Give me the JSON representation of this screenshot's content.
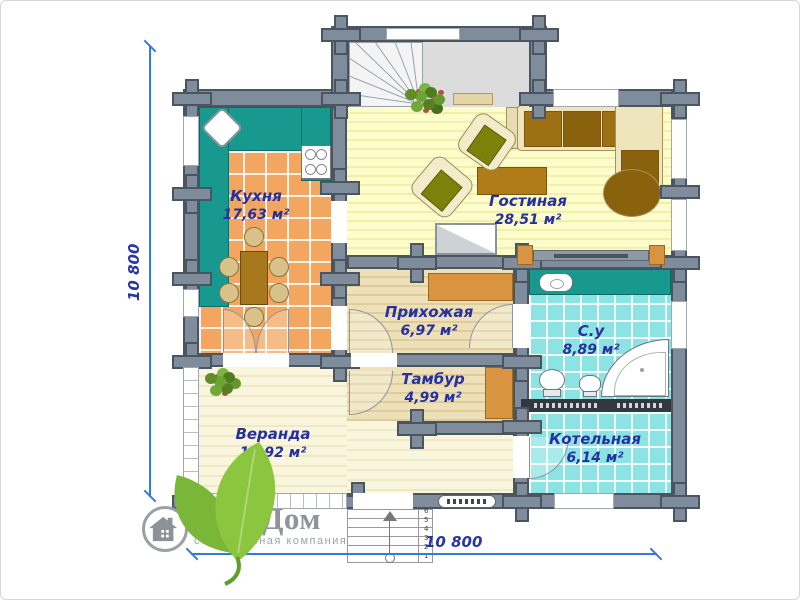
{
  "plan": {
    "rooms": [
      {
        "name": "Кухня",
        "area": "17,63 м²"
      },
      {
        "name": "Гостиная",
        "area": "28,51 м²"
      },
      {
        "name": "Прихожая",
        "area": "6,97 м²"
      },
      {
        "name": "Тамбур",
        "area": "4,99 м²"
      },
      {
        "name": "С.у",
        "area": "8,89 м²"
      },
      {
        "name": "Котельная",
        "area": "6,14 м²"
      },
      {
        "name": "Веранда",
        "area": "15,92 м²"
      }
    ],
    "dimensions": {
      "left": "10 800",
      "bottom": "10 800"
    },
    "entry_steps": {
      "numbers": [
        "1",
        "2",
        "3",
        "4",
        "5",
        "6"
      ]
    },
    "colors": {
      "wall": "#7e8c9c",
      "wall_outline": "#4a5560",
      "counter_teal": "#17998f",
      "kitchen_tile": "#f2a660",
      "bath_tile": "#8ce3e3",
      "living_floor": "#fdfccb",
      "hall_floor": "#eee0b8",
      "veranda_floor": "#faf6dd",
      "furniture_orange": "#d89440",
      "sofa_brown": "#9c7013",
      "dimension_blue": "#2f7de0",
      "label_navy": "#26309e",
      "logo_gray": "#8e949a",
      "leaf_green": "#8cc63e"
    }
  },
  "logo": {
    "title": "Ваш Дом",
    "subtitle": "строительная компания"
  }
}
